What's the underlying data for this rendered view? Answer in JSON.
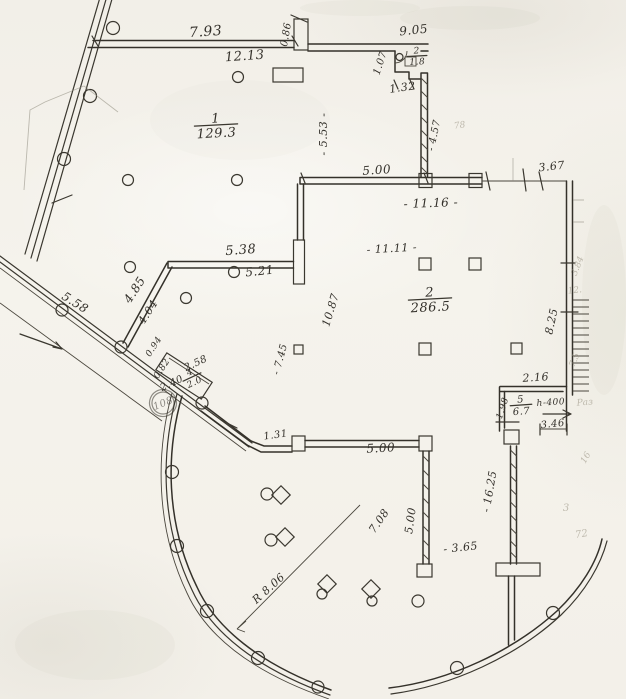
{
  "drawing": {
    "kind": "scanned floor plan",
    "ink_color": "#3a372f",
    "paper_color": "#f4f1ea",
    "pencil_color": "#9b9585"
  },
  "rooms": [
    {
      "name": "room-1",
      "num": "1",
      "den": "129.3",
      "x": 216,
      "y": 125,
      "r": -3,
      "s": 13
    },
    {
      "name": "room-2",
      "num": "2",
      "den": "286.5",
      "x": 430,
      "y": 299,
      "r": -3,
      "s": 13
    },
    {
      "name": "room-wc",
      "num": "2",
      "den": "1.8",
      "x": 417,
      "y": 56,
      "r": -3,
      "s": 9
    },
    {
      "name": "room-4",
      "num": "4",
      "den": "2.0",
      "x": 192,
      "y": 377,
      "r": -25,
      "s": 9
    },
    {
      "name": "room-5",
      "num": "5",
      "den": "6.7",
      "x": 521,
      "y": 405,
      "r": -4,
      "s": 10
    }
  ],
  "dimensions": [
    {
      "t": "7.93",
      "x": 206,
      "y": 36,
      "r": -4,
      "s": 14
    },
    {
      "t": "12.13",
      "x": 245,
      "y": 60,
      "r": -4,
      "s": 13
    },
    {
      "t": "0.86",
      "x": 289,
      "y": 35,
      "r": -80,
      "s": 10
    },
    {
      "t": "9.05",
      "x": 414,
      "y": 34,
      "r": -6,
      "s": 12
    },
    {
      "t": "1.07",
      "x": 383,
      "y": 64,
      "r": -72,
      "s": 10
    },
    {
      "t": "1.32",
      "x": 403,
      "y": 91,
      "r": -8,
      "s": 11
    },
    {
      "t": "- 5.53 -",
      "x": 327,
      "y": 134,
      "r": -90,
      "s": 11
    },
    {
      "t": "- 4.57",
      "x": 437,
      "y": 136,
      "r": -78,
      "s": 10
    },
    {
      "t": "5.00",
      "x": 377,
      "y": 174,
      "r": -4,
      "s": 12
    },
    {
      "t": "3.67",
      "x": 552,
      "y": 170,
      "r": -6,
      "s": 11
    },
    {
      "t": "- 11.16 -",
      "x": 431,
      "y": 207,
      "r": -2,
      "s": 12
    },
    {
      "t": "- 11.11 -",
      "x": 392,
      "y": 252,
      "r": -3,
      "s": 11
    },
    {
      "t": "5.38",
      "x": 241,
      "y": 254,
      "r": -4,
      "s": 13
    },
    {
      "t": "5.21",
      "x": 260,
      "y": 275,
      "r": -6,
      "s": 12
    },
    {
      "t": "4.85",
      "x": 138,
      "y": 292,
      "r": -57,
      "s": 12
    },
    {
      "t": "4.04",
      "x": 151,
      "y": 314,
      "r": -57,
      "s": 11
    },
    {
      "t": "5.58",
      "x": 73,
      "y": 306,
      "r": 32,
      "s": 12
    },
    {
      "t": "0.94",
      "x": 156,
      "y": 348,
      "r": -57,
      "s": 9
    },
    {
      "t": "0.82",
      "x": 164,
      "y": 370,
      "r": -57,
      "s": 9
    },
    {
      "t": "2.58",
      "x": 197,
      "y": 366,
      "r": -25,
      "s": 10
    },
    {
      "t": "2.40",
      "x": 173,
      "y": 386,
      "r": -25,
      "s": 10
    },
    {
      "t": "10.87",
      "x": 334,
      "y": 311,
      "r": -73,
      "s": 11
    },
    {
      "t": "- 7.45",
      "x": 283,
      "y": 360,
      "r": -75,
      "s": 10
    },
    {
      "t": "8.25",
      "x": 555,
      "y": 322,
      "r": -78,
      "s": 11
    },
    {
      "t": "2.16",
      "x": 536,
      "y": 381,
      "r": -4,
      "s": 11
    },
    {
      "t": "1.98",
      "x": 505,
      "y": 409,
      "r": -72,
      "s": 9
    },
    {
      "t": "3.46",
      "x": 553,
      "y": 427,
      "r": -6,
      "s": 10
    },
    {
      "t": "- 16.25",
      "x": 493,
      "y": 492,
      "r": -80,
      "s": 11
    },
    {
      "t": "1.31",
      "x": 276,
      "y": 438,
      "r": -8,
      "s": 10
    },
    {
      "t": "5.00",
      "x": 381,
      "y": 452,
      "r": -3,
      "s": 12
    },
    {
      "t": "5.00",
      "x": 414,
      "y": 521,
      "r": -82,
      "s": 11
    },
    {
      "t": "- 3.65",
      "x": 461,
      "y": 551,
      "r": -6,
      "s": 11
    },
    {
      "t": "7.08",
      "x": 382,
      "y": 523,
      "r": -55,
      "s": 11
    }
  ],
  "annotations": [
    {
      "t": "h-400",
      "x": 551,
      "y": 405,
      "r": -4,
      "s": 9,
      "name": "height-note"
    },
    {
      "t": "R 8.06",
      "x": 271,
      "y": 591,
      "r": -42,
      "s": 11,
      "name": "radius-label"
    }
  ],
  "stamp": {
    "t": "108",
    "x": 163,
    "y": 403,
    "r": -22
  },
  "faint_marks": [
    {
      "t": "78",
      "x": 460,
      "y": 128,
      "r": -8,
      "s": 9
    },
    {
      "t": "3.84",
      "x": 580,
      "y": 267,
      "r": -68,
      "s": 9
    },
    {
      "t": "12.",
      "x": 575,
      "y": 293,
      "r": -6,
      "s": 9
    },
    {
      "t": "7.5",
      "x": 577,
      "y": 361,
      "r": -68,
      "s": 9
    },
    {
      "t": "Раз",
      "x": 585,
      "y": 405,
      "r": -4,
      "s": 9
    },
    {
      "t": "16",
      "x": 588,
      "y": 459,
      "r": -60,
      "s": 9
    },
    {
      "t": "3",
      "x": 566,
      "y": 511,
      "r": 0,
      "s": 10
    },
    {
      "t": "72",
      "x": 582,
      "y": 537,
      "r": -10,
      "s": 10
    }
  ]
}
